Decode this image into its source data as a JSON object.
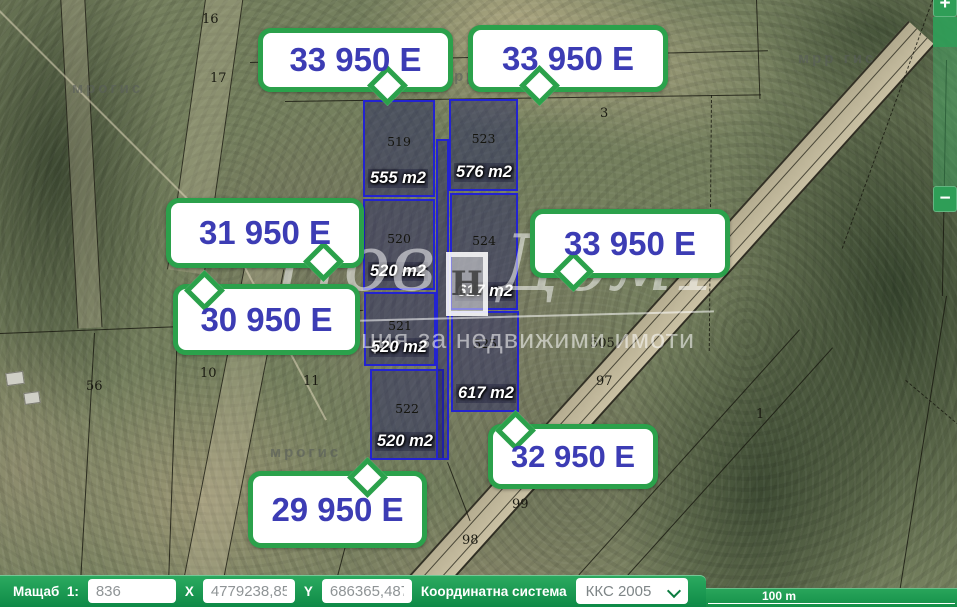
{
  "parcels": [
    {
      "number": "519",
      "area": "555 m2"
    },
    {
      "number": "523",
      "area": "576 m2"
    },
    {
      "number": "520",
      "area": "520 m2"
    },
    {
      "number": "524",
      "area": "617 m2"
    },
    {
      "number": "521",
      "area": "520 m2"
    },
    {
      "number": "525",
      "area": "617 m2"
    },
    {
      "number": "522",
      "area": "520 m2"
    }
  ],
  "price_bubbles": [
    "33 950 E",
    "33 950 E",
    "31 950 E",
    "30 950 E",
    "33 950 E",
    "32 950 E",
    "29 950 E"
  ],
  "plot_numbers": [
    "16",
    "17",
    "3",
    "56",
    "10",
    "11",
    "505",
    "97",
    "1",
    "99",
    "98"
  ],
  "ghost_marks": [
    "мрогис",
    "мрргис",
    "мрр гис",
    "мрогис"
  ],
  "watermark": {
    "word1": "Нов",
    "word2": "Дом1",
    "logo": "H",
    "tagline": "агенция за недвижими имоти"
  },
  "zoom_control": {
    "zoom_in": "+",
    "zoom_out": "−"
  },
  "statusbar": {
    "scale_label": "Мащаб  1:",
    "scale_value": "836",
    "x_label": "X",
    "x_value": "4779238,852",
    "y_label": "Y",
    "y_value": "686365,487",
    "coord_label": "Координатна система",
    "coord_value": "ККС 2005"
  },
  "scalebar": {
    "label": "100 m"
  },
  "colors": {
    "bubble_border": "#2ba14b",
    "bubble_text": "#3c3cb4",
    "statusbar_green": "#17934d",
    "parcel_blue": "#2323d0"
  }
}
